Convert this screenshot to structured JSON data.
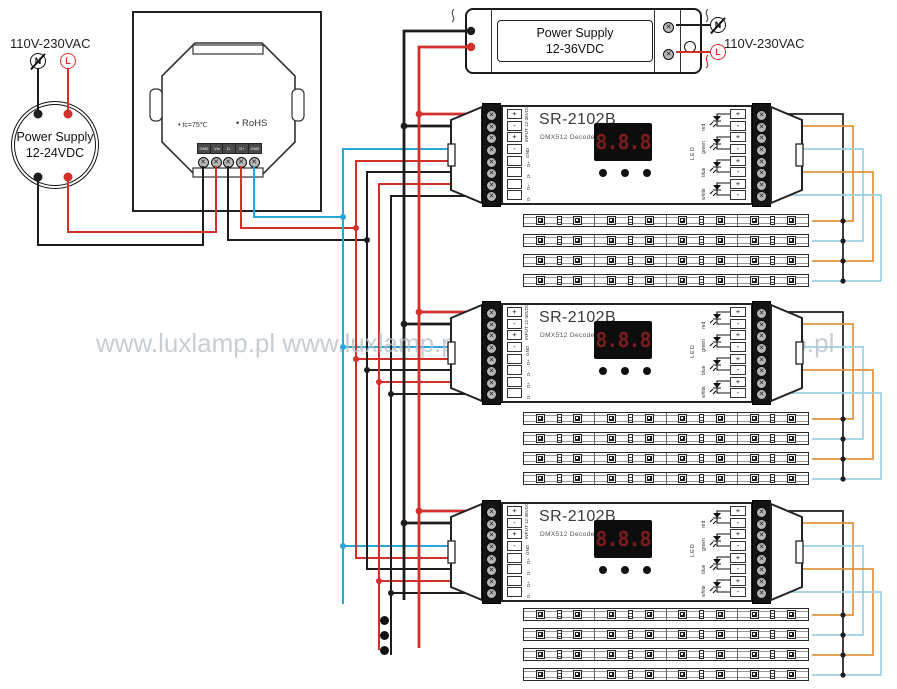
{
  "watermark": "www.luxlamp.pl www.luxlamp.pl www.luxlamp.pl www.luxlamp.pl",
  "mains": {
    "voltage_left": "110V-230VAC",
    "voltage_right": "110V-230VAC",
    "neutral": "N",
    "live": "L"
  },
  "round_psu": {
    "name_line1": "Power Supply",
    "name_line2": "12-24VDC"
  },
  "top_psu": {
    "name_line1": "Power Supply",
    "name_line2": "12-36VDC"
  },
  "wall_panel": {
    "marking_temp": "• tc=75℃",
    "marking_rohs": "• RoHS",
    "terminals": [
      "GND",
      "Vin",
      "D-",
      "D+",
      "GND"
    ]
  },
  "decoder": {
    "model": "SR-2102B",
    "type": "DMX512 Decoder",
    "display_value": "8.8.8",
    "input_label": "INPUT 12-36VDC",
    "gnd_label": "GND",
    "input_symbols": [
      "+",
      "-",
      "+",
      "-"
    ],
    "dmx_labels": [
      "D+",
      "D-",
      "D+",
      "D-"
    ],
    "output_polarity": [
      "+",
      "-"
    ],
    "channels": [
      "red",
      "green",
      "blue",
      "white"
    ],
    "outputs_label": "LED"
  },
  "colors": {
    "wire_black": "#1d1d1d",
    "wire_red": "#d3302c",
    "wire_blue": "#2ba6d8",
    "wire_orange": "#e0923d",
    "wire_blue_light": "#9dcfe6",
    "display_bg": "#0d0d0d",
    "display_digits": "#7c1d1d",
    "watermark": "#b9c2ca"
  }
}
